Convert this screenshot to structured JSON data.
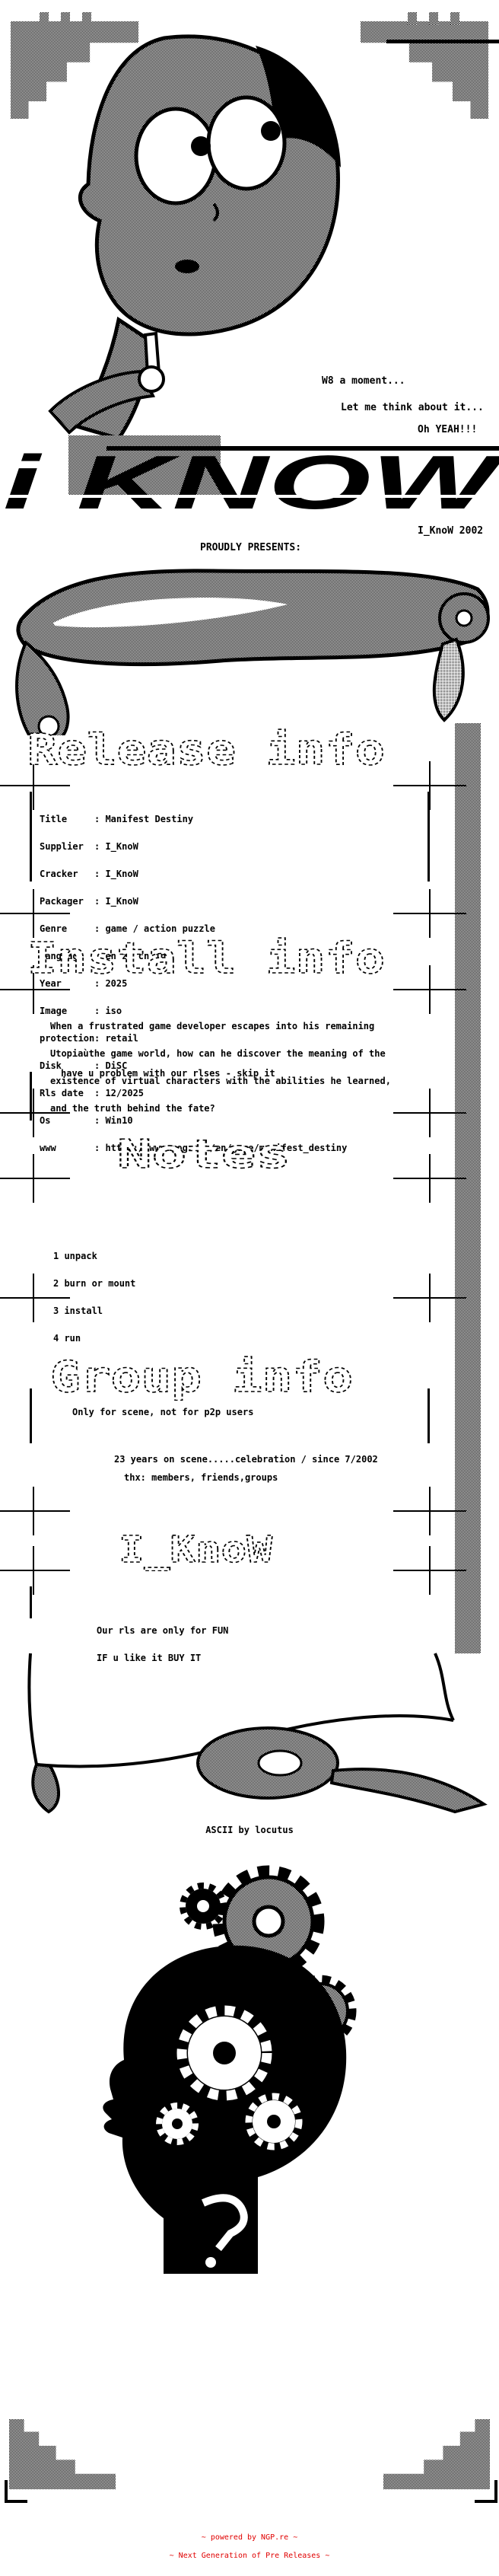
{
  "colors": {
    "ink": "#000000",
    "paper": "#ffffff",
    "footer_red": "#e00000"
  },
  "intro": {
    "speech": [
      "W8 a moment...",
      "Let me think about it...",
      "Oh YEAH!!!"
    ],
    "logo": "i KNOW",
    "logo_caption": "I_KnoW 2002",
    "presents": "PROUDLY PRESENTS:"
  },
  "release_info": {
    "heading": "Release info",
    "sep": ": ",
    "fields": [
      {
        "label": "Title",
        "value": "Manifest Destiny"
      },
      {
        "label": "Supplier",
        "value": "I_KnoW"
      },
      {
        "label": "Cracker",
        "value": "I_KnoW"
      },
      {
        "label": "Packager",
        "value": "I_KnoW"
      },
      {
        "label": "Genre",
        "value": "game / action puzzle"
      },
      {
        "label": "Language",
        "value": "en zh cn jp"
      },
      {
        "label": "Year",
        "value": "2025"
      },
      {
        "label": "Image",
        "value": "iso"
      },
      {
        "label": "protection",
        "value": "retail"
      },
      {
        "label": "Disk",
        "value": "DiSC"
      },
      {
        "label": "Rls date",
        "value": "12/2025"
      },
      {
        "label": "Os",
        "value": "Win10"
      },
      {
        "label": "www",
        "value": "https://www.gog.com/en/game/manifest_destiny"
      }
    ]
  },
  "install_info": {
    "heading": "Install info",
    "description_lines": [
      "When a frustrated game developer escapes into his remaining",
      "Utopiaùthe game world, how can he discover the meaning of the",
      "existence of virtual characters with the abilities he learned,",
      "and the truth behind the fate?"
    ],
    "skip_note": "have u problem with our rlses - skip it"
  },
  "notes": {
    "heading": "Notes",
    "steps": [
      "1 unpack",
      "2 burn or mount",
      "3 install",
      "4 run"
    ]
  },
  "group_info": {
    "heading": "Group info",
    "scene_note": "Only for scene, not for p2p users",
    "anniversary": "23 years on scene.....celebration / since 7/2002",
    "thanks": "thx: members, friends,groups"
  },
  "signoff": {
    "heading": "I_KnoW",
    "lines": [
      "Our rls are only for FUN",
      "IF u like it BUY IT"
    ]
  },
  "credits": {
    "ascii_by": "ASCII by locutus"
  },
  "footer": {
    "line1": "~ powered by NGP.re ~",
    "line2": "~ Next Generation of Pre Releases ~"
  },
  "art": {
    "head": "thinking-cartoon-head",
    "scroll_top": "parchment-scroll-top",
    "scroll_bottom": "parchment-scroll-bottom",
    "gears_head": "gears-inside-head-silhouette"
  }
}
